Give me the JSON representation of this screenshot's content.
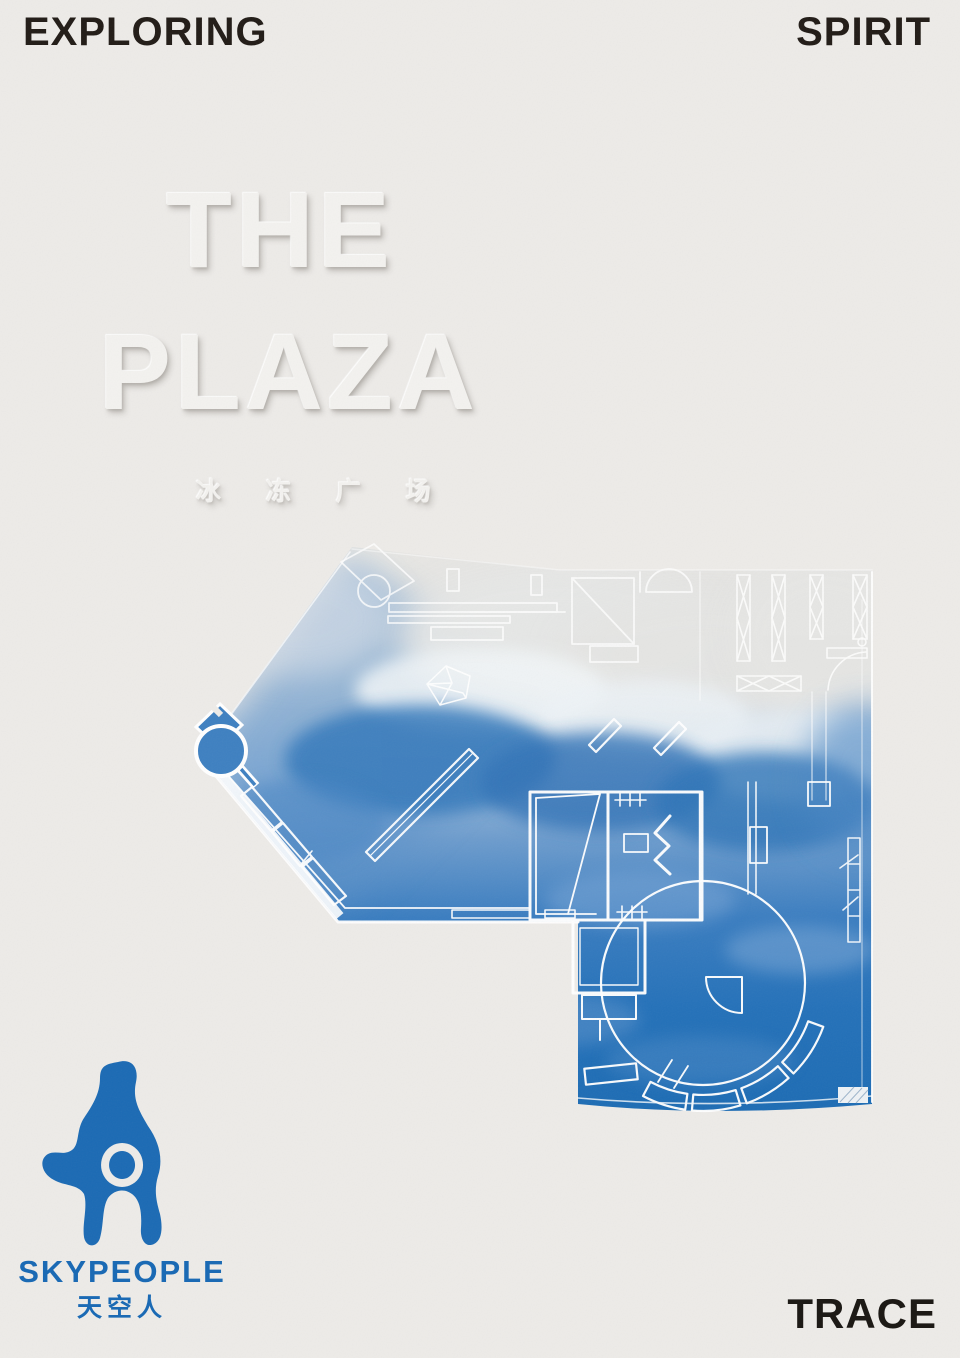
{
  "poster": {
    "header": {
      "left": "EXPLORING",
      "right": "SPIRIT"
    },
    "footer": {
      "right": "TRACE"
    },
    "title": {
      "line1": "THE",
      "line2": "PLAZA",
      "subtitle_cn": "冰 冻 广 场"
    },
    "logo": {
      "wordmark": "SKYPEOPLE",
      "wordmark_cn": "天空人"
    },
    "artwork": {
      "name": "frozen-plaza-floor-plan",
      "description": "White architectural floor-plan linework over a sky wash fading from pale grey clouds to deep blue"
    },
    "colors": {
      "paper": "#edebe8",
      "ink": "#211b16",
      "brand_blue": "#1b6ab4",
      "sky_deep": "#1d6cb4",
      "sky_mid": "#4886c4",
      "sky_pale": "#d4dbe1",
      "line_white": "#ffffff"
    }
  }
}
